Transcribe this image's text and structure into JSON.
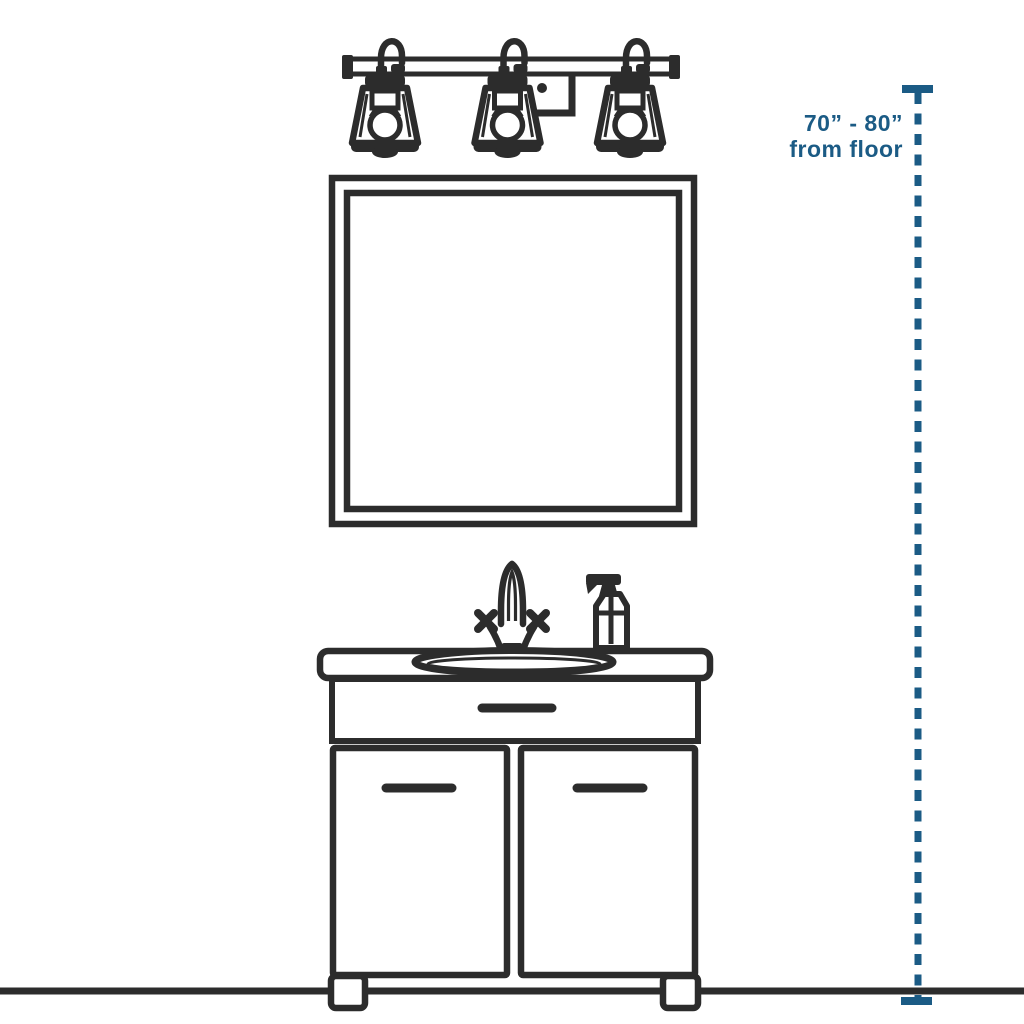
{
  "page": {
    "background": "#ffffff",
    "description_labels": []
  },
  "colors": {
    "ink": "#2c2c2c",
    "accent": "#1b5b85",
    "fill": "#ffffff"
  },
  "measurement": {
    "range": "70” - 80”",
    "caption": "from floor"
  },
  "scene": {
    "parts": [
      "three-light-vanity-fixture",
      "mirror",
      "faucet",
      "soap-dispenser",
      "sink-basin",
      "vanity-countertop",
      "vanity-drawer",
      "vanity-doors",
      "vanity-feet",
      "floor-line",
      "height-measurement-line"
    ],
    "light_count": 3
  }
}
